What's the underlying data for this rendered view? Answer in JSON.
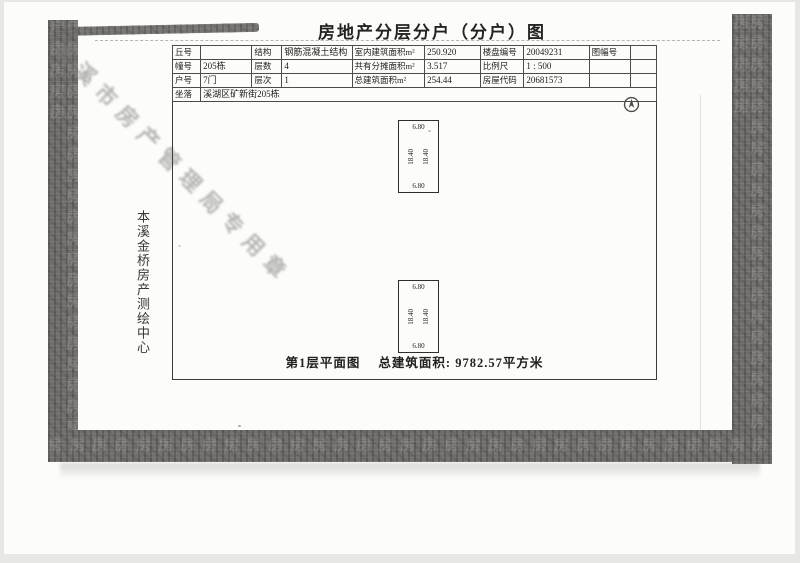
{
  "page": {
    "title": "房地产分层分户（分户）图",
    "side_vertical_text": "本溪金桥房产测绘中心",
    "caption": {
      "plan_label": "第1层平面图",
      "area_label": "总建筑面积:",
      "area_value": "9782.57平方米"
    }
  },
  "info_table": {
    "rows": [
      {
        "cells": [
          {
            "label": "丘号",
            "value": ""
          },
          {
            "label": "结构",
            "value": "钢筋混凝土结构"
          },
          {
            "label": "室内建筑面积m²",
            "value": "250.920"
          },
          {
            "label": "楼盘编号",
            "value": "20049231"
          },
          {
            "label": "图幅号",
            "value": ""
          }
        ]
      },
      {
        "cells": [
          {
            "label": "幢号",
            "value": "205栋"
          },
          {
            "label": "层数",
            "value": "4"
          },
          {
            "label": "共有分摊面积m²",
            "value": "3.517"
          },
          {
            "label": "比例尺",
            "value": "1 : 500"
          },
          {
            "label": "",
            "value": ""
          }
        ]
      },
      {
        "cells": [
          {
            "label": "户号",
            "value": "7门"
          },
          {
            "label": "层次",
            "value": "1"
          },
          {
            "label": "总建筑面积m²",
            "value": "254.44"
          },
          {
            "label": "房屋代码",
            "value": "20681573"
          },
          {
            "label": "",
            "value": ""
          }
        ]
      }
    ],
    "address": {
      "label": "坐落",
      "value": "溪湖区矿新街205栋"
    }
  },
  "floor_plan": {
    "units": [
      {
        "top_dim": "6.80",
        "bottom_dim": "6.80",
        "left_dim": "18.40",
        "right_dim": "18.40"
      },
      {
        "top_dim": "6.80",
        "bottom_dim": "6.80",
        "left_dim": "18.40",
        "right_dim": "18.40"
      }
    ]
  },
  "scan_artifacts": {
    "diagonal_bleed_text": "本溪市房产管理局专用章",
    "band_glyph": "房"
  },
  "colors": {
    "paper": "#fcfcfa",
    "band": "#716f6d",
    "line": "#3c3c3c",
    "ink": "#1f1f1f"
  }
}
